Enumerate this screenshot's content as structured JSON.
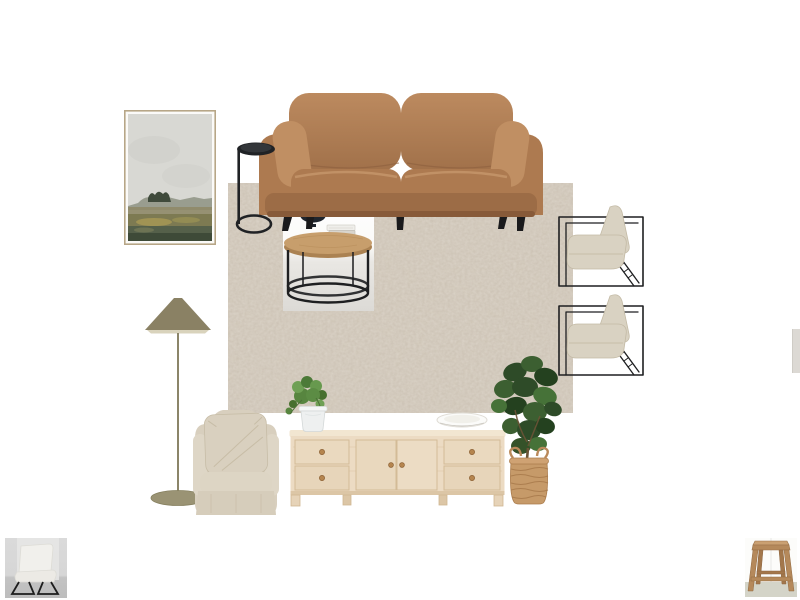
{
  "canvas": {
    "background": "#ffffff",
    "width": 800,
    "height": 600
  },
  "board": {
    "items": [
      {
        "name": "framed-landscape-art",
        "label": "framed landscape artwork"
      },
      {
        "name": "tan-leather-sofa",
        "label": "tan leather two seater sofa with black tapered legs"
      },
      {
        "name": "black-side-table",
        "label": "black round pedestal side table"
      },
      {
        "name": "distressed-beige-rug",
        "label": "distressed beige area rug"
      },
      {
        "name": "round-coffee-table",
        "label": "round timber coffee table with black metal ring base, dark bowl and stacked books"
      },
      {
        "name": "accent-armchair-1",
        "label": "oatmeal cushion accent chair with thin black metal frame"
      },
      {
        "name": "accent-armchair-2",
        "label": "oatmeal cushion accent chair with thin black metal frame"
      },
      {
        "name": "olive-floor-lamp",
        "label": "floor lamp with olive cone shade and round base"
      },
      {
        "name": "slipcover-armchair",
        "label": "natural linen slipcover armchair with large cushion"
      },
      {
        "name": "potted-trailing-plant",
        "label": "small green plant in white pot"
      },
      {
        "name": "whitewashed-tv-console",
        "label": "whitewashed oak sideboard with four drawers and two doors"
      },
      {
        "name": "white-bowl",
        "label": "white decorative plate on console"
      },
      {
        "name": "fiddle-leaf-fig",
        "label": "fiddle leaf fig tree in woven jute basket"
      },
      {
        "name": "partial-item-right-edge",
        "label": "partially visible item at right canvas edge"
      },
      {
        "name": "thumbnail-white-accent-chair",
        "label": "white accent chair with black sled legs thumbnail"
      },
      {
        "name": "thumbnail-rustic-wood-stool",
        "label": "rustic timber stool thumbnail"
      }
    ]
  },
  "colors": {
    "sofa_leather": "#ad7a50",
    "sofa_leather_light": "#c08f63",
    "sofa_leg": "#1a1a1c",
    "rug_base": "#ccc2b3",
    "rug_mottle": "#988b76",
    "art_frame": "#b7a687",
    "art_sky": "#d8d8d3",
    "art_land": "#6d7354",
    "lamp_shade": "#8a8164",
    "metal_black": "#1e1f21",
    "chair_cushion": "#d9d2c2",
    "armchair_fabric": "#d8cfbe",
    "console_wood": "#ecdbc3",
    "coffee_table_top": "#c79e6c",
    "basket": "#c69a69",
    "leaf_green": "#35552c",
    "pot_white": "#eef0f0",
    "plate_white": "#fbfbf9"
  }
}
